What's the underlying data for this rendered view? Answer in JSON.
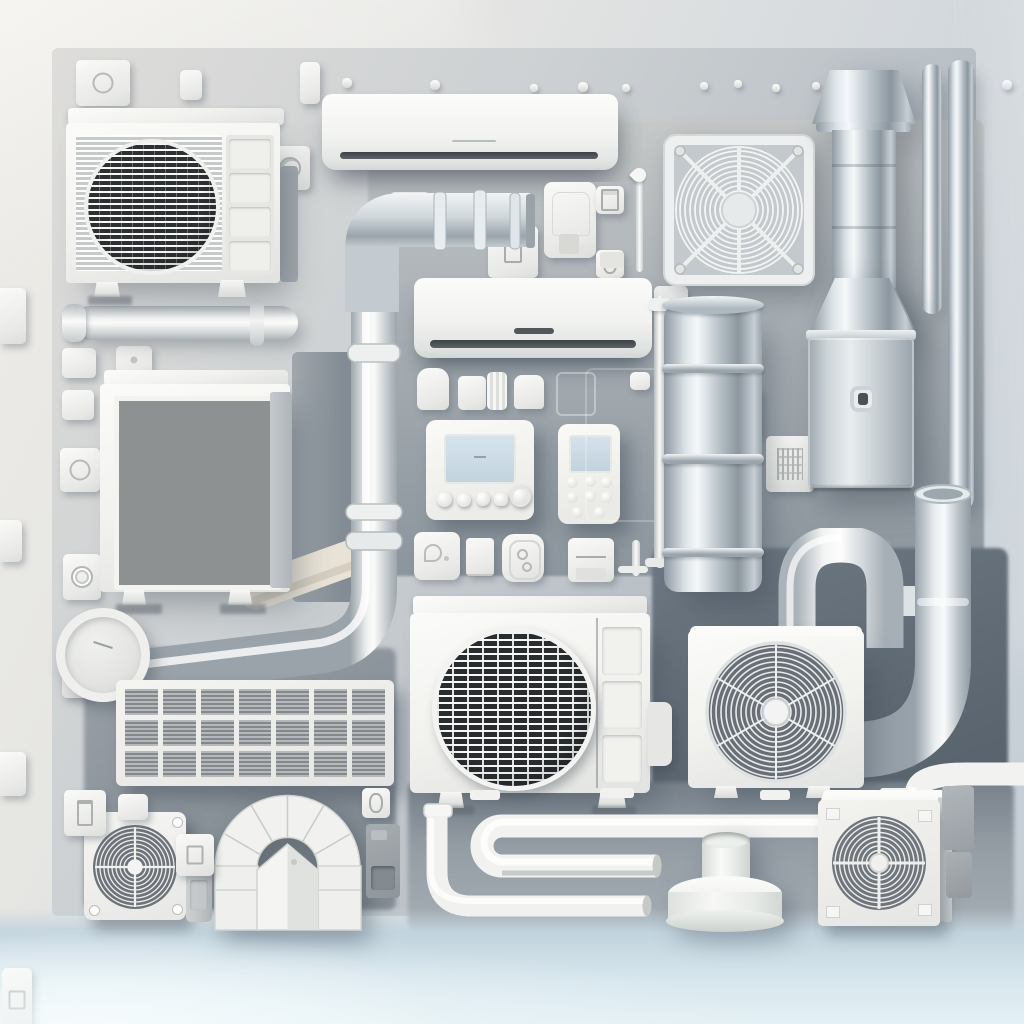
{
  "meta": {
    "type": "illustration",
    "subject": "Flat-lay style 3D rendered collage of HVAC equipment: air-conditioner condensers, wall-mounted split units, axial fans, air filters, thermostats, remote controls, galvanized ducts and white conduit pipes arranged on a soft gray studio wall with a pale blue floor",
    "style": "soft painterly 3D render, white and galvanized-metal palette, diffuse lighting from upper left",
    "canvas": {
      "width": 1024,
      "height": 1024
    },
    "visible_text": "none"
  },
  "palette": {
    "wall_light": "#edebe6",
    "wall_cool": "#c6cfd6",
    "panel_gray": "#9aa2aa",
    "panel_slate": "#5f6a74",
    "panel_soft": "#8d959c",
    "floor_blue": "#d4e3ea",
    "unit_white": "#f2f2ef",
    "metal_highlight": "#f5f8f9",
    "metal_mid": "#aeb8bf",
    "metal_shadow": "#8a949c",
    "grille_dark": "#33373a",
    "grille_gray": "#8d9194",
    "lcd_blue": "#cddde8",
    "vent_slot": "#4e5357",
    "soft_shadow": "rgba(56,66,79,0.32)"
  },
  "objects": {
    "wall": {
      "label": "Soft studio wall with cool gradient",
      "bbox": [
        0,
        0,
        1024,
        1024
      ]
    },
    "backdrop": {
      "label": "Light gray recessed backdrop panel",
      "bbox": [
        52,
        48,
        924,
        868
      ]
    },
    "panel_center": {
      "label": "Medium gray wall panel behind center components",
      "bbox": [
        368,
        120,
        616,
        456
      ]
    },
    "panel_dark": {
      "label": "Dark slate wall panel, lower right",
      "bbox": [
        652,
        548,
        356,
        368
      ]
    },
    "panel_lower_left": {
      "label": "Gray wall panel behind bottom-left items",
      "bbox": [
        84,
        648,
        312,
        262
      ]
    },
    "panel_band": {
      "label": "Gray band behind bottom pipe runs",
      "bbox": [
        408,
        782,
        606,
        150
      ]
    },
    "floor": {
      "label": "Pale blue studio floor",
      "bbox": [
        0,
        908,
        1024,
        116
      ]
    },
    "hardware_strip": {
      "label": "Row of small switches, end caps and fasteners along the top",
      "bbox": [
        56,
        50,
        968,
        80
      ]
    },
    "condenser_a": {
      "label": "Outdoor AC condenser unit with louvered round fan grille",
      "bbox": [
        66,
        108,
        240,
        212
      ]
    },
    "wall_ac_a": {
      "label": "Wall-mounted mini-split indoor AC unit, wide",
      "bbox": [
        322,
        94,
        296,
        76
      ]
    },
    "fan_guard": {
      "label": "Square axial fan with circular wire guard and corner screws",
      "bbox": [
        663,
        134,
        152,
        152
      ]
    },
    "chimney": {
      "label": "Galvanized flue duct with flared cap and skirt",
      "bbox": [
        812,
        70,
        104,
        262
      ]
    },
    "pipe_stack": {
      "label": "Pair of galvanized pipes, top right corner",
      "bbox": [
        922,
        60,
        52,
        452
      ]
    },
    "elbow_duct": {
      "label": "Segmented galvanized elbow duct",
      "bbox": [
        338,
        186,
        200,
        126
      ]
    },
    "sensor_set": {
      "label": "Motion-sensor box with two square switch buttons",
      "bbox": [
        544,
        176,
        100,
        96
      ]
    },
    "left_column": {
      "label": "Column of small electrical fittings on left edge",
      "bbox": [
        0,
        286,
        150,
        592
      ]
    },
    "wall_pipe": {
      "label": "White conduit pipe stub on left wall",
      "bbox": [
        62,
        304,
        236,
        40
      ]
    },
    "filter_slab": {
      "label": "Dark slab behind filter cabinet",
      "bbox": [
        292,
        352,
        70,
        250
      ]
    },
    "conduit_center": {
      "label": "White conduit run with couplings and sweep elbow to lower left",
      "bbox": [
        90,
        240,
        420,
        460
      ]
    },
    "filter_unit": {
      "label": "Air filter cabinet with dusty pleated media",
      "bbox": [
        100,
        370,
        200,
        250
      ]
    },
    "clock_vent": {
      "label": "Round wall vent with dial face",
      "bbox": [
        56,
        608,
        76,
        76
      ]
    },
    "vent_wide": {
      "label": "Wide slatted return-air grille, 7 by 3 cells",
      "bbox": [
        116,
        680,
        278,
        106
      ]
    },
    "wall_ac_b": {
      "label": "Wall-mounted mini-split indoor AC unit, compact",
      "bbox": [
        414,
        278,
        238,
        80
      ]
    },
    "trim_row": {
      "label": "Row of plastic end caps and trim pieces",
      "bbox": [
        414,
        366,
        280,
        46
      ]
    },
    "thermostat": {
      "label": "Programmable thermostat with LCD and five round buttons",
      "bbox": [
        426,
        420,
        108,
        100
      ]
    },
    "remote": {
      "label": "Handheld AC remote control with button grid",
      "bbox": [
        558,
        424,
        62,
        100
      ]
    },
    "switch_row": {
      "label": "Wall switches and socket plates",
      "bbox": [
        412,
        530,
        236,
        52
      ]
    },
    "slim_conduit": {
      "label": "Slim conduit riser with coupling and tee foot",
      "bbox": [
        644,
        290,
        32,
        286
      ]
    },
    "cylinder_duct": {
      "label": "Galvanized round duct section with ring seams",
      "bbox": [
        664,
        296,
        100,
        300
      ]
    },
    "air_handler": {
      "label": "Metal air-handler cabinet with funnel collar and sight knob",
      "bbox": [
        806,
        278,
        112,
        216
      ]
    },
    "n_pipe": {
      "label": "Inverted-U white conduit bridge",
      "bbox": [
        770,
        528,
        180,
        120
      ]
    },
    "j_duct": {
      "label": "Large duct riser with sweep elbow, open end",
      "bbox": [
        790,
        470,
        234,
        330
      ]
    },
    "condenser_b": {
      "label": "Outdoor AC condenser unit with grid fan guard",
      "bbox": [
        410,
        596,
        260,
        216
      ]
    },
    "ring_fan": {
      "label": "Condenser fan unit with spiral wire guard",
      "bbox": [
        688,
        626,
        176,
        172
      ]
    },
    "ledge_tabs": {
      "label": "Small white mounting tabs on ledge",
      "bbox": [
        455,
        782,
        470,
        20
      ]
    },
    "pipe_runs": {
      "label": "U-shaped white pipe run and low conduit with elbow",
      "bbox": [
        410,
        760,
        620,
        190
      ]
    },
    "vent_collar": {
      "label": "Round roof-vent collar on base",
      "bbox": [
        668,
        836,
        118,
        100
      ]
    },
    "exhaust_fan": {
      "label": "Compact exhaust fan with spiral guard",
      "bbox": [
        84,
        812,
        102,
        108
      ]
    },
    "fan_side_panel": {
      "label": "Slatted side panel beside exhaust fan",
      "bbox": [
        186,
        834,
        26,
        88
      ]
    },
    "arch_duct": {
      "label": "Arched segmented duct assembly with gable insert",
      "bbox": [
        208,
        786,
        160,
        146
      ]
    },
    "arch_switch": {
      "label": "Switch and junction box beside arch",
      "bbox": [
        360,
        788,
        42,
        112
      ]
    },
    "bl_fittings": {
      "label": "Small fittings near bottom-left fan",
      "bbox": [
        62,
        786,
        156,
        58
      ]
    },
    "box_fan": {
      "label": "Compact box fan unit with cross-braced spiral guard",
      "bbox": [
        818,
        790,
        134,
        144
      ]
    },
    "br_blocks": {
      "label": "Gray junction blocks, bottom right",
      "bbox": [
        942,
        786,
        34,
        114
      ]
    }
  }
}
